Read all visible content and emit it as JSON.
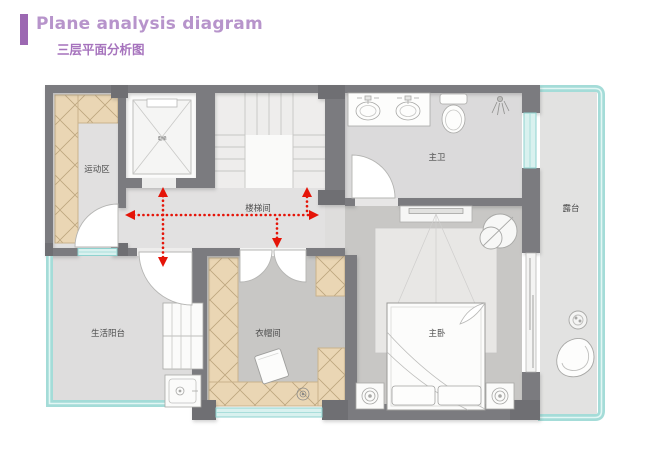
{
  "header": {
    "title": "Plane analysis diagram",
    "subtitle": "三层平面分析图"
  },
  "rooms": {
    "activity_area": {
      "label": "运动区"
    },
    "elevator": {
      "label": "电梯"
    },
    "stair_hall": {
      "label": "楼梯间"
    },
    "master_bathroom": {
      "label": "主卫"
    },
    "terrace": {
      "label": "露台"
    },
    "living_balcony": {
      "label": "生活阳台"
    },
    "cloakroom": {
      "label": "衣帽间"
    },
    "master_bedroom": {
      "label": "主卧"
    }
  },
  "colors": {
    "accent_bar_purple": "#9c68b2",
    "title_purple": "#b794cb",
    "subtitle_purple": "#a673bd",
    "wall_gray": "#7b7b7f",
    "pier_gray": "#6c6c70",
    "glass_teal": "#8ed2cf",
    "cabinet_tan": "#ead6b4",
    "floor_light": "#e1e0e0",
    "floor_mid": "#c8c7c5",
    "arrow_red": "#e51408"
  }
}
